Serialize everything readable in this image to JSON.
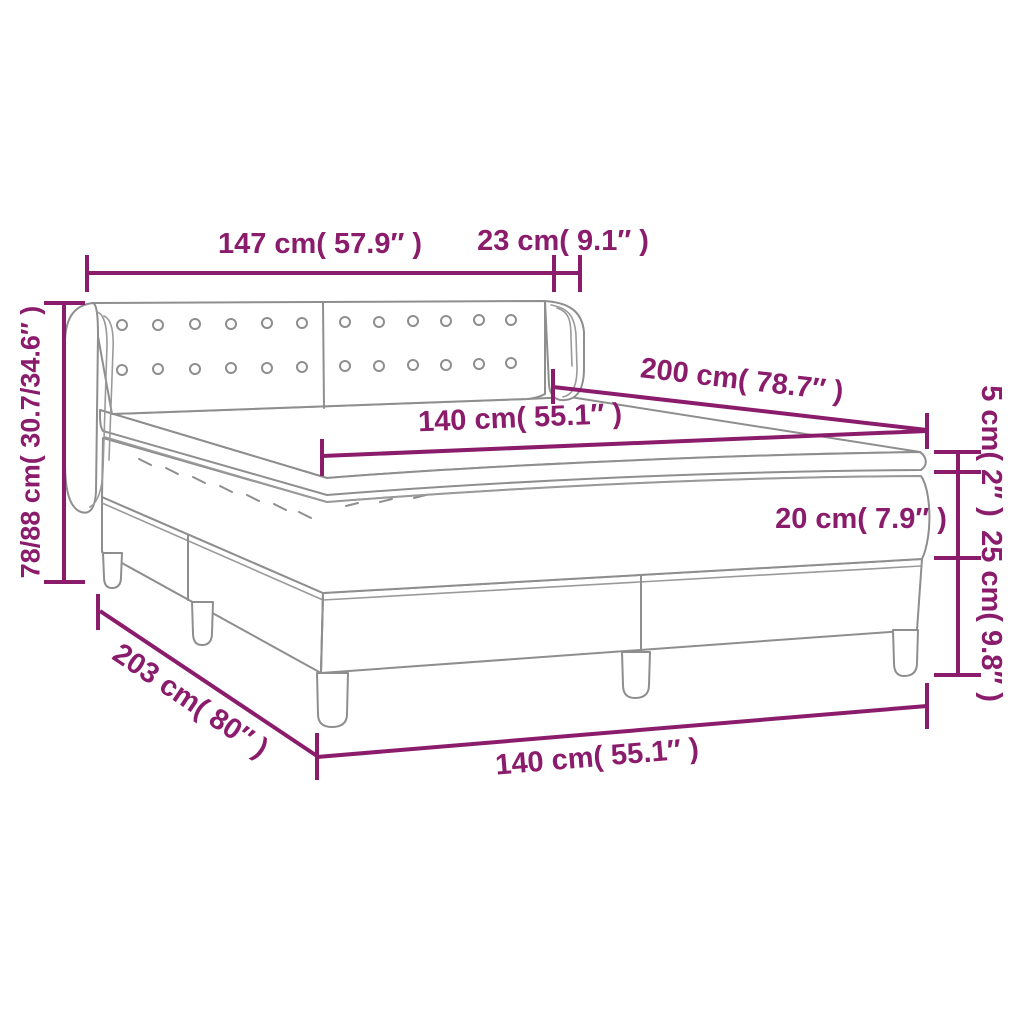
{
  "diagram": {
    "subject": "box-spring-bed-dimension-diagram",
    "colors": {
      "dimension_accent": "#8a1c6b",
      "drawing_outline": "#8e8e8e",
      "background": "#ffffff"
    },
    "dimensions": {
      "headboard_width": "147 cm( 57.9″ )",
      "wing_depth": "23 cm( 9.1″ )",
      "overall_height": "78/88 cm( 30.7/34.6″ )",
      "bed_length": "200 cm( 78.7″ )",
      "sleeping_width": "140 cm( 55.1″ )",
      "topper_thickness": "5 cm( 2″ )",
      "mattress_thickness": "20 cm( 7.9″ )",
      "base_height": "25 cm( 9.8″ )",
      "frame_length": "203 cm( 80″ )",
      "frame_width": "140 cm( 55.1″ )"
    }
  }
}
